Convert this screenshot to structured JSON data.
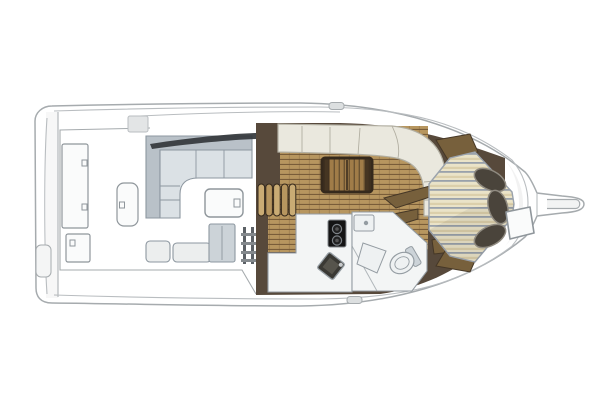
{
  "meta": {
    "title": "Yacht deck and cabin floor plan (top view, bow to the right)",
    "diagram_type": "boat-floorplan",
    "orientation": "bow-right"
  },
  "canvas": {
    "width": 606,
    "height": 402,
    "background": "#ffffff"
  },
  "palette": {
    "hull_outline": "#a6abae",
    "hull_fill": "#ffffff",
    "deck_line": "#b9bdc0",
    "windshield": "#33373b",
    "bulkhead_brown": "#57493b",
    "wood_base": "#b7965f",
    "wood_light": "#c9ab74",
    "wood_line": "#6e5433",
    "wood_trim": "#77603c",
    "wood_trim_dark": "#453726",
    "table_wood": "#a07c48",
    "table_border": "#35291c",
    "settee_cream": "#eae8de",
    "settee_outline": "#b2afa2",
    "cockpit_sofa_seat": "#dbe1e5",
    "cockpit_sofa_back": "#b9c1c8",
    "cockpit_sofa_outline": "#8d97a0",
    "hatch_fill": "#fafbfb",
    "hatch_outline": "#8f969b",
    "bench_fill": "#eceeee",
    "cabinet_fill": "#ccd3d8",
    "bed_base": "#eae3c8",
    "bed_stripe": "#99a1ab",
    "bed_stripe_tan": "#d8cca6",
    "bed_outline": "#9aa2ac",
    "pillow": "#4a443b",
    "pillow_outline": "#8f8a80",
    "stove_body": "#141414",
    "stove_ring": "#7d8287",
    "fixture_fill": "#eef1f2",
    "fixture_outline": "#949ca2",
    "head_floor": "#f3f5f5",
    "metal_dark": "#5c6166",
    "metal_light": "#84898d"
  },
  "areas": {
    "swim_platform": {
      "label": "swim platform / transom"
    },
    "cockpit": {
      "label": "cockpit",
      "deck_hatches": 3,
      "seating": "L-shaped sofa",
      "cocktail_table": 1,
      "aft_benches": 2
    },
    "salon": {
      "label": "salon",
      "flooring": "teak planks",
      "settee": "curved cream settee",
      "table": "wood table",
      "companionway_steps": 5
    },
    "galley": {
      "label": "galley",
      "burners": 2,
      "sink": 1
    },
    "head": {
      "label": "head compartment",
      "toilet": 1,
      "sink": 1,
      "shower_seat": 1
    },
    "v_berth": {
      "label": "V-berth cabin",
      "pillows": 3,
      "bedding": "striped"
    },
    "foredeck": {
      "label": "foredeck",
      "deck_hatch": 1
    },
    "bow_pulpit": {
      "label": "bow pulpit",
      "anchor_roller": 1
    }
  }
}
